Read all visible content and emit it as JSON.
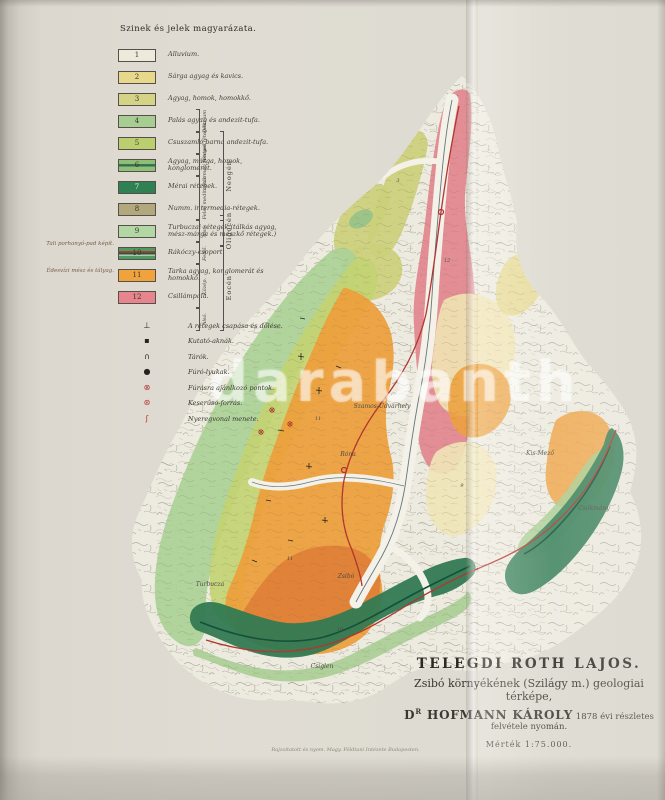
{
  "legend": {
    "title": "Szinek és jelek magyarázata.",
    "items": [
      {
        "num": "1",
        "label": "Alluvium.",
        "color": "#eeeadb"
      },
      {
        "num": "2",
        "label": "Sárga agyag és kavics.",
        "color": "#e8d88b"
      },
      {
        "num": "3",
        "label": "Agyag, homok, homokkő.",
        "color": "#d5d385"
      },
      {
        "num": "4",
        "label": "Palás agyag és andezit-tufa.",
        "color": "#a7cd93"
      },
      {
        "num": "5",
        "label": "Csuszamló barna andezit-tufa.",
        "color": "#bccf6e"
      },
      {
        "num": "6",
        "label": "Agyag, márga, homok, konglomerát.",
        "color": "#8fbe77",
        "stripes": [
          "#8fbe77 0%",
          "#8fbe77 34%",
          "#2f6f4e 40%",
          "#2f6f4e 56%",
          "#8fbe77 62%",
          "#8fbe77 100%"
        ]
      },
      {
        "num": "7",
        "label": "Mérai rétegek.",
        "color": "#2f8153",
        "num_color": "#e9e6da"
      },
      {
        "num": "8",
        "label": "Numm. intermedia-rétegek.",
        "color": "#b3a87d"
      },
      {
        "num": "9",
        "label": "Turbuczai rétegek (tálkás agyag, mész-márga és mészkő rétegek.)",
        "color": "#b2d6a4"
      },
      {
        "num": "10",
        "label": "Rákóczy-csoport.",
        "color": "#4f9a63",
        "stripes": [
          "#4f9a63 0%",
          "#4f9a63 26%",
          "#b23a30 30%",
          "#b23a30 40%",
          "#1f5c3e 46%",
          "#1f5c3e 58%",
          "#e8e4d8 62%",
          "#e8e4d8 66%",
          "#4f9a63 72%",
          "#4f9a63 100%"
        ]
      },
      {
        "num": "11",
        "label": "Tarka agyag, konglomerát és homokkő.",
        "color": "#f0a23c"
      },
      {
        "num": "12",
        "label": "Csillámpala.",
        "color": "#e6858d"
      }
    ],
    "sub_groups": [
      "Diluvium",
      "Pontusi rétegek",
      "Szármáti rétegek",
      "Felső mediterrán",
      "Alsó.",
      "Felső.",
      "Közép.",
      "Alsó."
    ],
    "era_groups": [
      "Neogén",
      "Oligocén",
      "Eocén"
    ],
    "side_notes": [
      "Tali porhanyó-pad képít.",
      "Édesvízi mész és tályag."
    ]
  },
  "symbols": {
    "items": [
      {
        "icon": "strike-dip-icon",
        "glyph": "⊥",
        "color": "#26231f",
        "label": "A rétegek csapása és dőlése."
      },
      {
        "icon": "shaft-icon",
        "glyph": "▪",
        "color": "#26231f",
        "label": "Kutató-aknák."
      },
      {
        "icon": "adit-icon",
        "glyph": "∩",
        "color": "#26231f",
        "label": "Tárók."
      },
      {
        "icon": "borehole-icon",
        "glyph": "●",
        "color": "#26231f",
        "label": "Fúró-lyukak."
      },
      {
        "icon": "drill-point-icon",
        "glyph": "⊗",
        "color": "#b23530",
        "label": "Fúrásra ajánlkozó pontok."
      },
      {
        "icon": "bitter-spring-icon",
        "glyph": "⊛",
        "color": "#b23530",
        "label": "Keserűsó-forrás."
      },
      {
        "icon": "fold-axis-icon",
        "glyph": "ʃ",
        "color": "#b23530",
        "label": "Nyeregvonal menete."
      }
    ]
  },
  "map": {
    "accent_red": "#b23530",
    "labels": [
      {
        "text": "12",
        "x": 447,
        "y": 262,
        "size": 5
      },
      {
        "text": "3",
        "x": 398,
        "y": 182,
        "size": 5
      },
      {
        "text": "11",
        "x": 318,
        "y": 420,
        "size": 5
      },
      {
        "text": "11",
        "x": 290,
        "y": 560,
        "size": 5
      },
      {
        "text": "10",
        "x": 340,
        "y": 631,
        "size": 5
      },
      {
        "text": "9",
        "x": 462,
        "y": 487,
        "size": 5
      },
      {
        "text": "Szamos-Udvarhely",
        "x": 382,
        "y": 408,
        "size": 6
      },
      {
        "text": "Róna",
        "x": 348,
        "y": 456,
        "size": 6
      },
      {
        "text": "Zsibó",
        "x": 346,
        "y": 578,
        "size": 6
      },
      {
        "text": "Turbucza",
        "x": 210,
        "y": 586,
        "size": 6
      },
      {
        "text": "Csiglen",
        "x": 322,
        "y": 668,
        "size": 6
      },
      {
        "text": "Csókmány",
        "x": 594,
        "y": 510,
        "size": 6
      },
      {
        "text": "Kis-Mező",
        "x": 540,
        "y": 455,
        "size": 6
      }
    ]
  },
  "title_block": {
    "author": "TELEGDI ROTH LAJOS.",
    "subtitle": "Zsibó környékének (Szilágy m.) geologiai térképe,",
    "credit_prefix": "D",
    "credit_sup": "R",
    "credit_name": " HOFMANN KÁROLY",
    "credit_rest": " 1878 évi részletes felvétele nyomán.",
    "scale_note": "Mérték 1:75.000."
  },
  "imprint": "Rajzoltatott és nyom. Magy. Földtani Intézete Budapesten.",
  "watermark": {
    "text": "darabanth"
  }
}
